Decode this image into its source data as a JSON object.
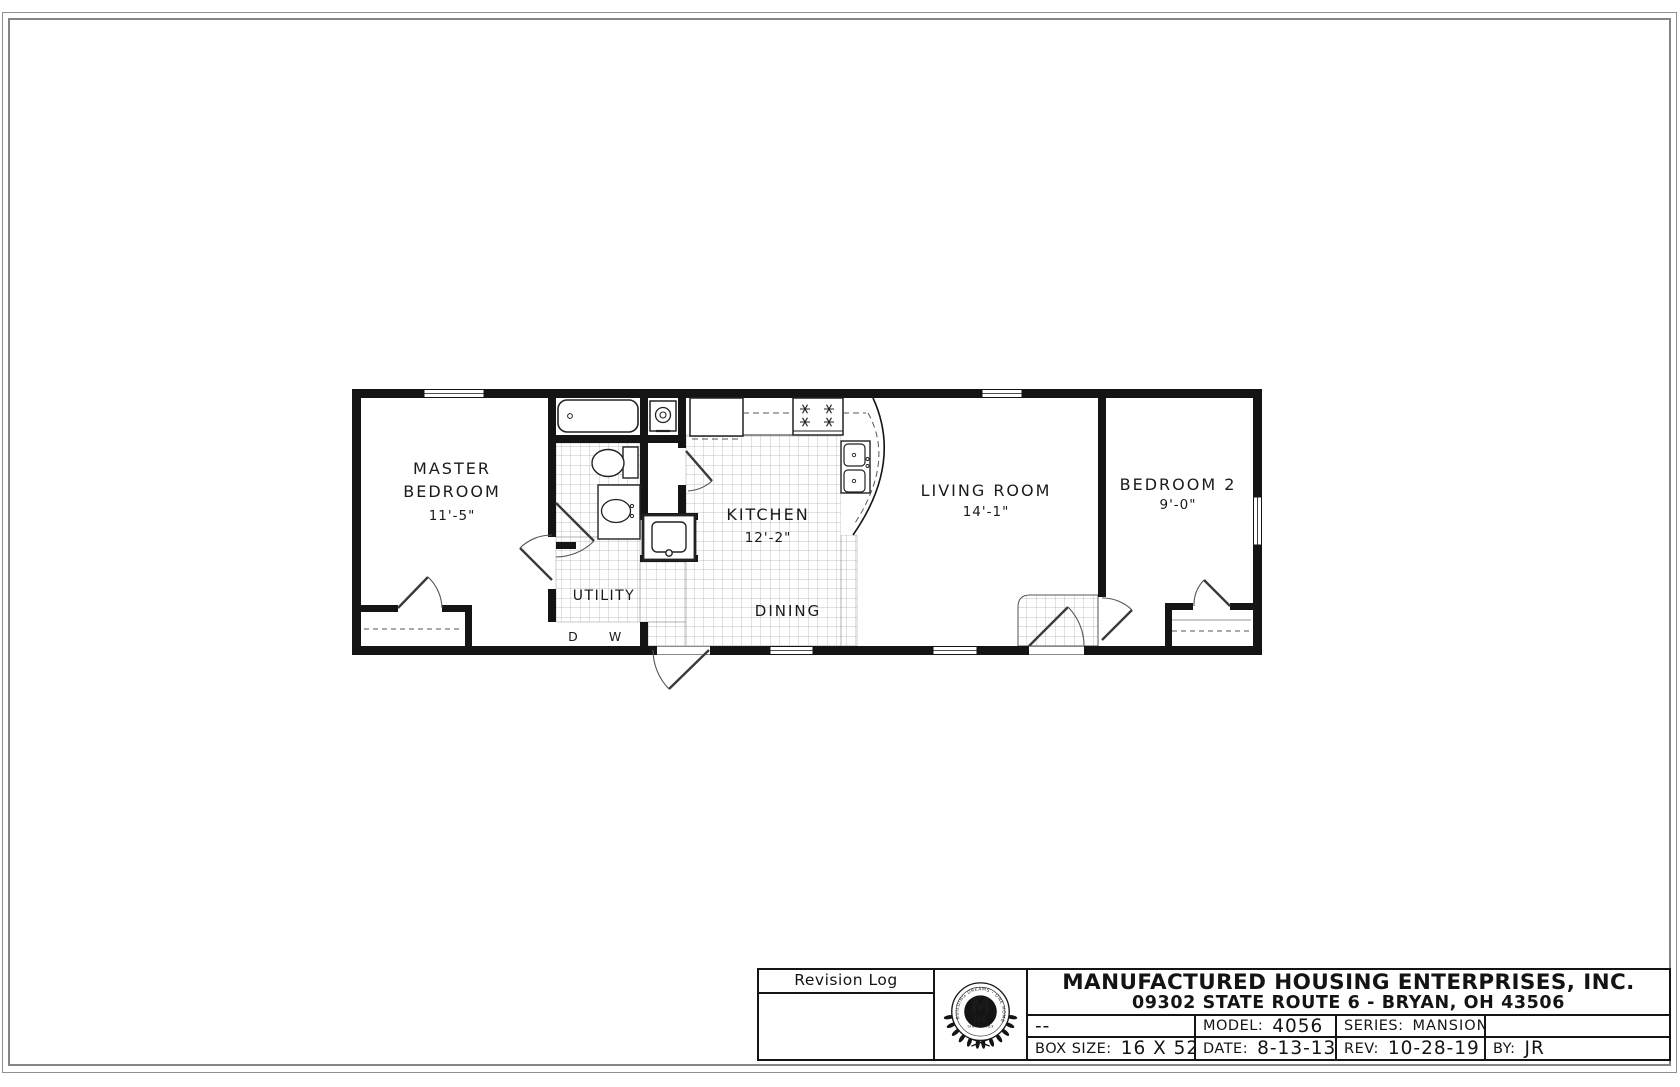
{
  "page": {
    "background": "#ffffff",
    "frame_color": "#8f8f8f",
    "line_color": "#141414"
  },
  "plan": {
    "rooms": {
      "master": {
        "line1": "MASTER",
        "line2": "BEDROOM",
        "dim": "11'-5\""
      },
      "kitchen": {
        "name": "KITCHEN",
        "dim": "12'-2\""
      },
      "dining": {
        "name": "DINING"
      },
      "utility": {
        "name": "UTILITY"
      },
      "living": {
        "name": "LIVING ROOM",
        "dim": "14'-1\""
      },
      "bedroom2": {
        "name": "BEDROOM 2",
        "dim": "9'-0\""
      }
    },
    "hookups": {
      "dryer": "D",
      "washer": "W"
    }
  },
  "title_block": {
    "revision_log_title": "Revision Log",
    "revision_placeholder": "--",
    "company_name": "MANUFACTURED HOUSING ENTERPRISES, INC.",
    "company_address": "09302 STATE ROUTE 6 - BRYAN, OH 43506",
    "model_label": "MODEL:",
    "model_value": "4056",
    "series_label": "SERIES:",
    "series_value": "MANSION",
    "box_size_label": "BOX SIZE:",
    "box_size_value": "16 X 52",
    "date_label": "DATE:",
    "date_value": "8-13-13",
    "rev_label": "REV:",
    "rev_value": "10-28-19",
    "by_label": "BY:",
    "by_value": "JR",
    "logo": {
      "monogram_top": "M",
      "monogram_bottom": "HE",
      "ring_text": "BUILDING DREAMS - ONE HOME AT A TIME",
      "since_text": "SINCE 1963"
    }
  }
}
